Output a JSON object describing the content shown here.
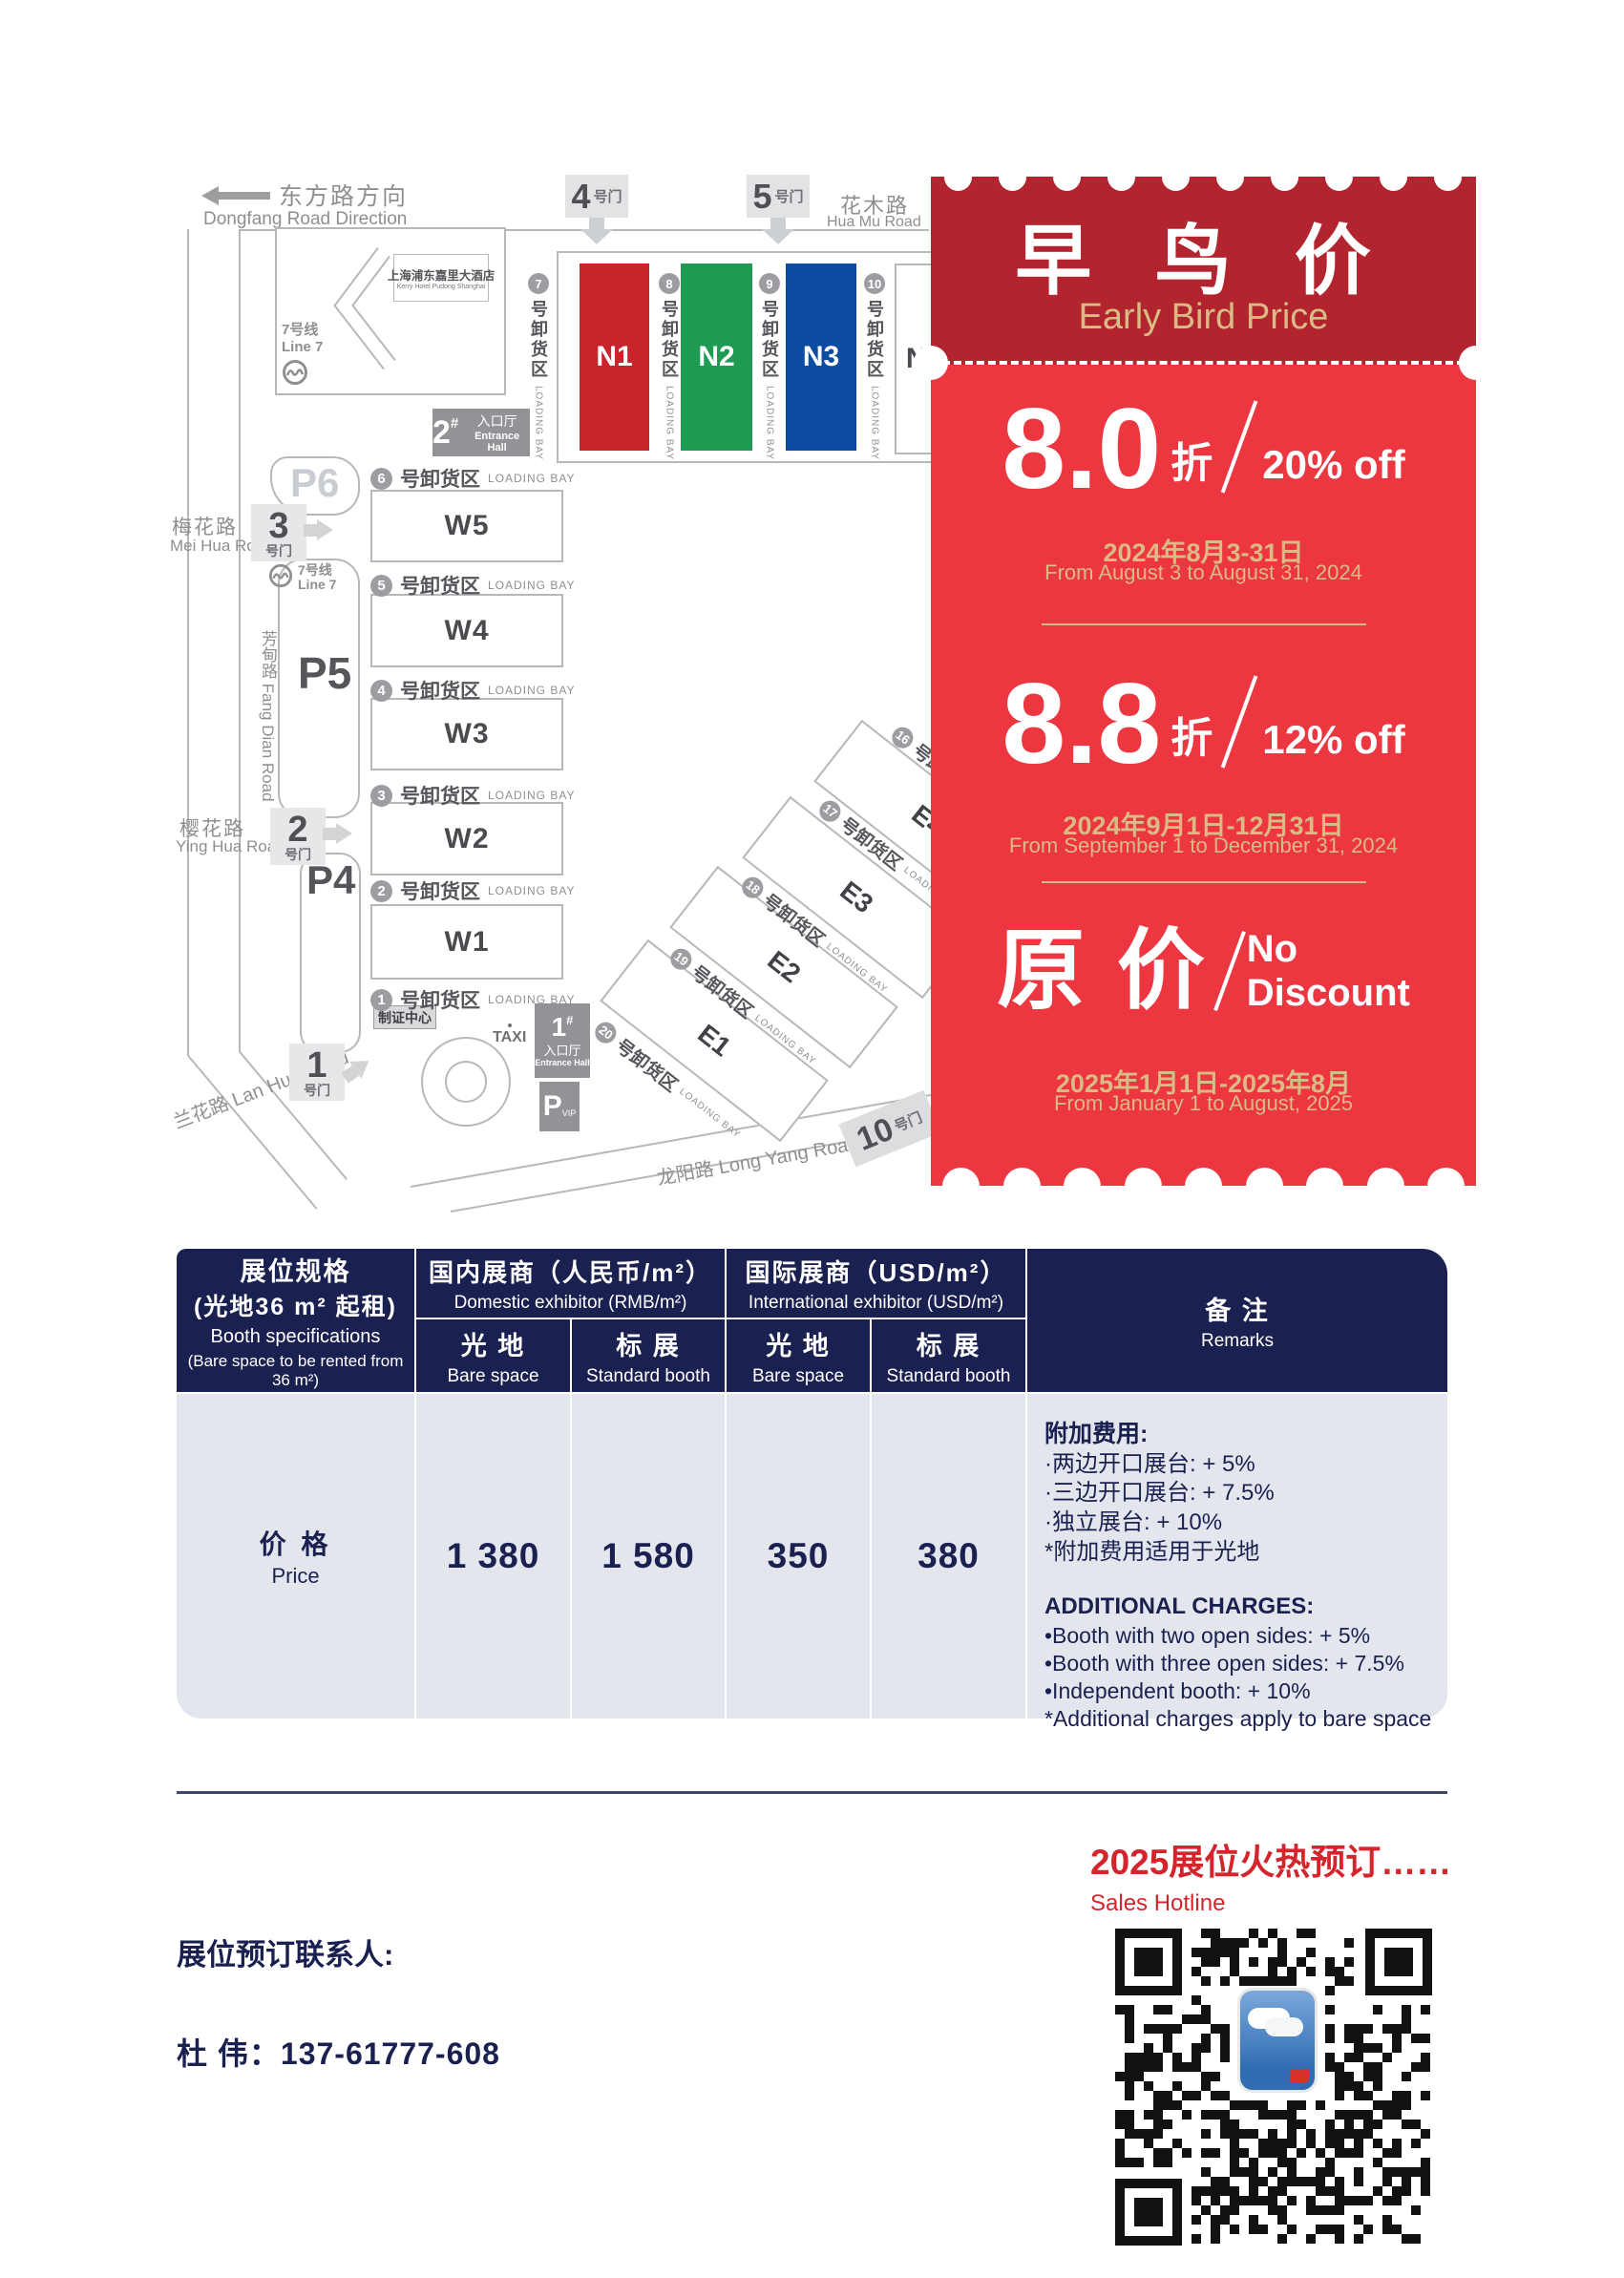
{
  "map": {
    "direction_zh": "东方路方向",
    "direction_en": "Dongfang Road Direction",
    "hotel_zh": "上海浦东嘉里大酒店",
    "hotel_en": "Kerry Hotel Pudong Shanghai",
    "metro_zh": "7号线",
    "metro_en": "Line 7",
    "roads": {
      "huamu_zh": "花木路",
      "huamu_en": "Hua Mu Road",
      "meihua_zh": "梅花路",
      "meihua_en": "Mei Hua Road",
      "fangdian_zh": "芳甸路",
      "fangdian_en": "Fang Dian Road",
      "yinghua_zh": "樱花路",
      "yinghua_en": "Ying Hua Road",
      "lanhua_zh": "兰花路",
      "lanhua_en": "Lan Hua Road",
      "longyang_zh": "龙阳路",
      "longyang_en": "Long Yang Road"
    },
    "bay_zh": "号卸货区",
    "bay_en": "LOADING BAY",
    "halls_w": [
      "W5",
      "W4",
      "W3",
      "W2",
      "W1"
    ],
    "bays_w": [
      "6",
      "5",
      "4",
      "3",
      "2",
      "1"
    ],
    "halls_n": [
      {
        "label": "N1",
        "color": "#c7242c",
        "text": "#ffffff"
      },
      {
        "label": "N2",
        "color": "#1e9a52",
        "text": "#ffffff"
      },
      {
        "label": "N3",
        "color": "#0c4da2",
        "text": "#ffffff"
      },
      {
        "label": "N4",
        "color": "#ffffff",
        "text": "#4a4b4f"
      }
    ],
    "bays_n": [
      "7",
      "8",
      "9",
      "10"
    ],
    "halls_e": [
      "E4",
      "E3",
      "E2",
      "E1"
    ],
    "bays_e": [
      "16",
      "17",
      "18",
      "19",
      "20"
    ],
    "gate_label": "号门",
    "gates_top": [
      "4",
      "5"
    ],
    "gates_left": [
      "3",
      "2",
      "1"
    ],
    "gate10": "10",
    "entrance2": {
      "num": "2",
      "hash": "#",
      "zh": "入口厅",
      "en": "Entrance Hall"
    },
    "entrance1": {
      "num": "1",
      "hash": "#",
      "zh": "入口厅",
      "en": "Entrance Hall"
    },
    "badge_center": "制证中心",
    "taxi": "TAXI",
    "parking": [
      "P6",
      "P5",
      "P4"
    ],
    "vip_p": "P",
    "vip_sub": "VIP",
    "icons": {
      "metro": "metro-logo",
      "direction": "left-arrow",
      "gate_arrow": "fat-arrow"
    }
  },
  "coupon": {
    "title_zh": "早 鸟 价",
    "title_en": "Early Bird Price",
    "colors": {
      "dark_red": "#b3252e",
      "bright_red": "#ec3640",
      "gold": "#d9bb85"
    },
    "tiers": [
      {
        "big": "8.0",
        "unit": "折",
        "off": "20% off",
        "date_zh": "2024年8月3-31日",
        "date_en": "From August 3 to August 31, 2024"
      },
      {
        "big": "8.8",
        "unit": "折",
        "off": "12% off",
        "date_zh": "2024年9月1日-12月31日",
        "date_en": "From September 1 to December 31, 2024"
      },
      {
        "big": "原 价",
        "off1": "No",
        "off2": "Discount",
        "date_zh": "2025年1月1日-2025年8月",
        "date_en": "From January 1 to August, 2025"
      }
    ]
  },
  "table": {
    "colors": {
      "header_navy": "#1a2151",
      "body_grey": "#e3e7ed"
    },
    "spec_zh1": "展位规格",
    "spec_zh2": "(光地36 m² 起租)",
    "spec_en1": "Booth specifications",
    "spec_en2": "(Bare space to be rented from 36 m²)",
    "domestic_zh": "国内展商（人民币/m²）",
    "domestic_en": "Domestic exhibitor (RMB/m²)",
    "intl_zh": "国际展商（USD/m²）",
    "intl_en": "International exhibitor (USD/m²)",
    "bare_zh": "光 地",
    "bare_en": "Bare space",
    "std_zh": "标 展",
    "std_en": "Standard booth",
    "remarks_zh": "备 注",
    "remarks_en": "Remarks",
    "price_zh": "价 格",
    "price_en": "Price",
    "values": [
      "1 380",
      "1 580",
      "350",
      "380"
    ],
    "remarks": {
      "zh_title": "附加费用:",
      "zh_items": [
        "·两边开口展台: + 5%",
        "·三边开口展台: + 7.5%",
        "·独立展台: + 10%",
        "*附加费用适用于光地"
      ],
      "en_title": "ADDITIONAL CHARGES:",
      "en_items": [
        "•Booth with two open sides: + 5%",
        "•Booth with three open sides: + 7.5%",
        "•Independent booth: + 10%",
        "*Additional charges apply to bare space"
      ]
    }
  },
  "footer": {
    "hotline_zh": "2025展位火热预订……",
    "hotline_en": "Sales Hotline",
    "contact_label": "展位预订联系人:",
    "contact": "杜  伟：137-61777-608",
    "qr_icon": "qr-code"
  }
}
